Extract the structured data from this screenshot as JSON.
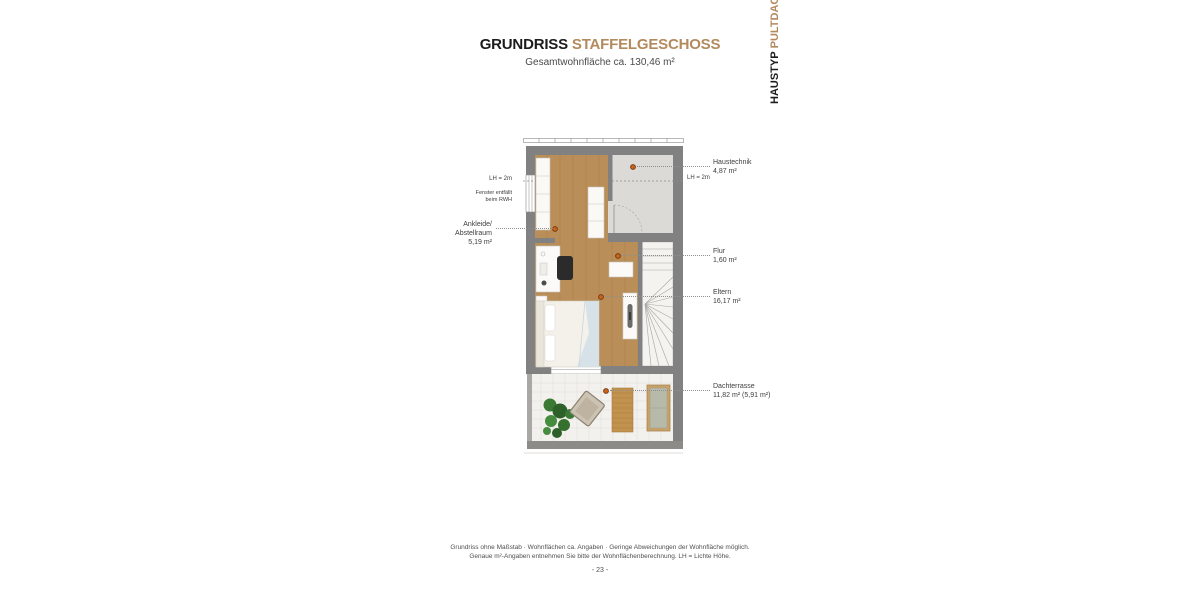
{
  "header": {
    "title": "GRUNDRISS",
    "title_accent": "STAFFELGESCHOSS",
    "subtitle": "Gesamtwohnfläche ca. 130,46 m²"
  },
  "housetype": {
    "label": "HAUSTYP",
    "label_accent": "PULTDACH"
  },
  "plan": {
    "rooms_right": [
      {
        "name": "Haustechnik",
        "area": "4,87 m²"
      },
      {
        "name": "Flur",
        "area": "1,60 m²"
      },
      {
        "name": "Eltern",
        "area": "16,17 m²"
      },
      {
        "name": "Dachterrasse",
        "area": "11,82 m² (5,91 m²)"
      }
    ],
    "room_left": {
      "line1": "Ankleide/",
      "line2": "Abstellraum",
      "area": "5,19 m²"
    },
    "annotations": {
      "lh_left": "LH = 2m",
      "lh_right": "LH = 2m",
      "fenster_line1": "Fenster entfällt",
      "fenster_line2": "beim RWH"
    }
  },
  "footer": {
    "line1": "Grundriss ohne Maßstab · Wohnflächen ca. Angaben · Geringe Abweichungen der Wohnfläche möglich.",
    "line2": "Genaue m²-Angaben entnehmen Sie bitte der Wohnflächenberechnung. LH = Lichte Höhe.",
    "page": "- 23 -"
  },
  "colors": {
    "accent": "#b38a5d",
    "wall": "#818181",
    "wood_floor": "#b98e58",
    "tech_floor": "#dcdad7",
    "terrace_floor": "#f3f1ee",
    "marker": "#c8651b"
  }
}
